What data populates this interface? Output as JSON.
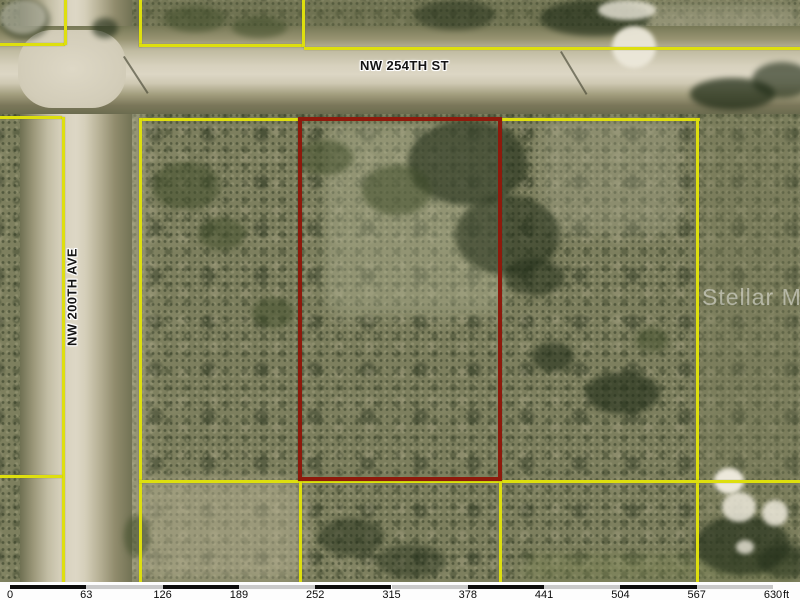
{
  "map": {
    "street_labels": {
      "horizontal": "NW 254TH ST",
      "vertical": "NW 200TH AVE"
    },
    "watermark_text": "Stellar MLS",
    "colors": {
      "parcel_line_yellow": "#dedf0e",
      "highlighted_parcel_red": "#8e1a0c"
    },
    "scale_bar": {
      "tick_labels": [
        "0",
        "63",
        "126",
        "189",
        "252",
        "315",
        "378",
        "441",
        "504",
        "567",
        "630"
      ],
      "unit_label": "ft"
    }
  }
}
